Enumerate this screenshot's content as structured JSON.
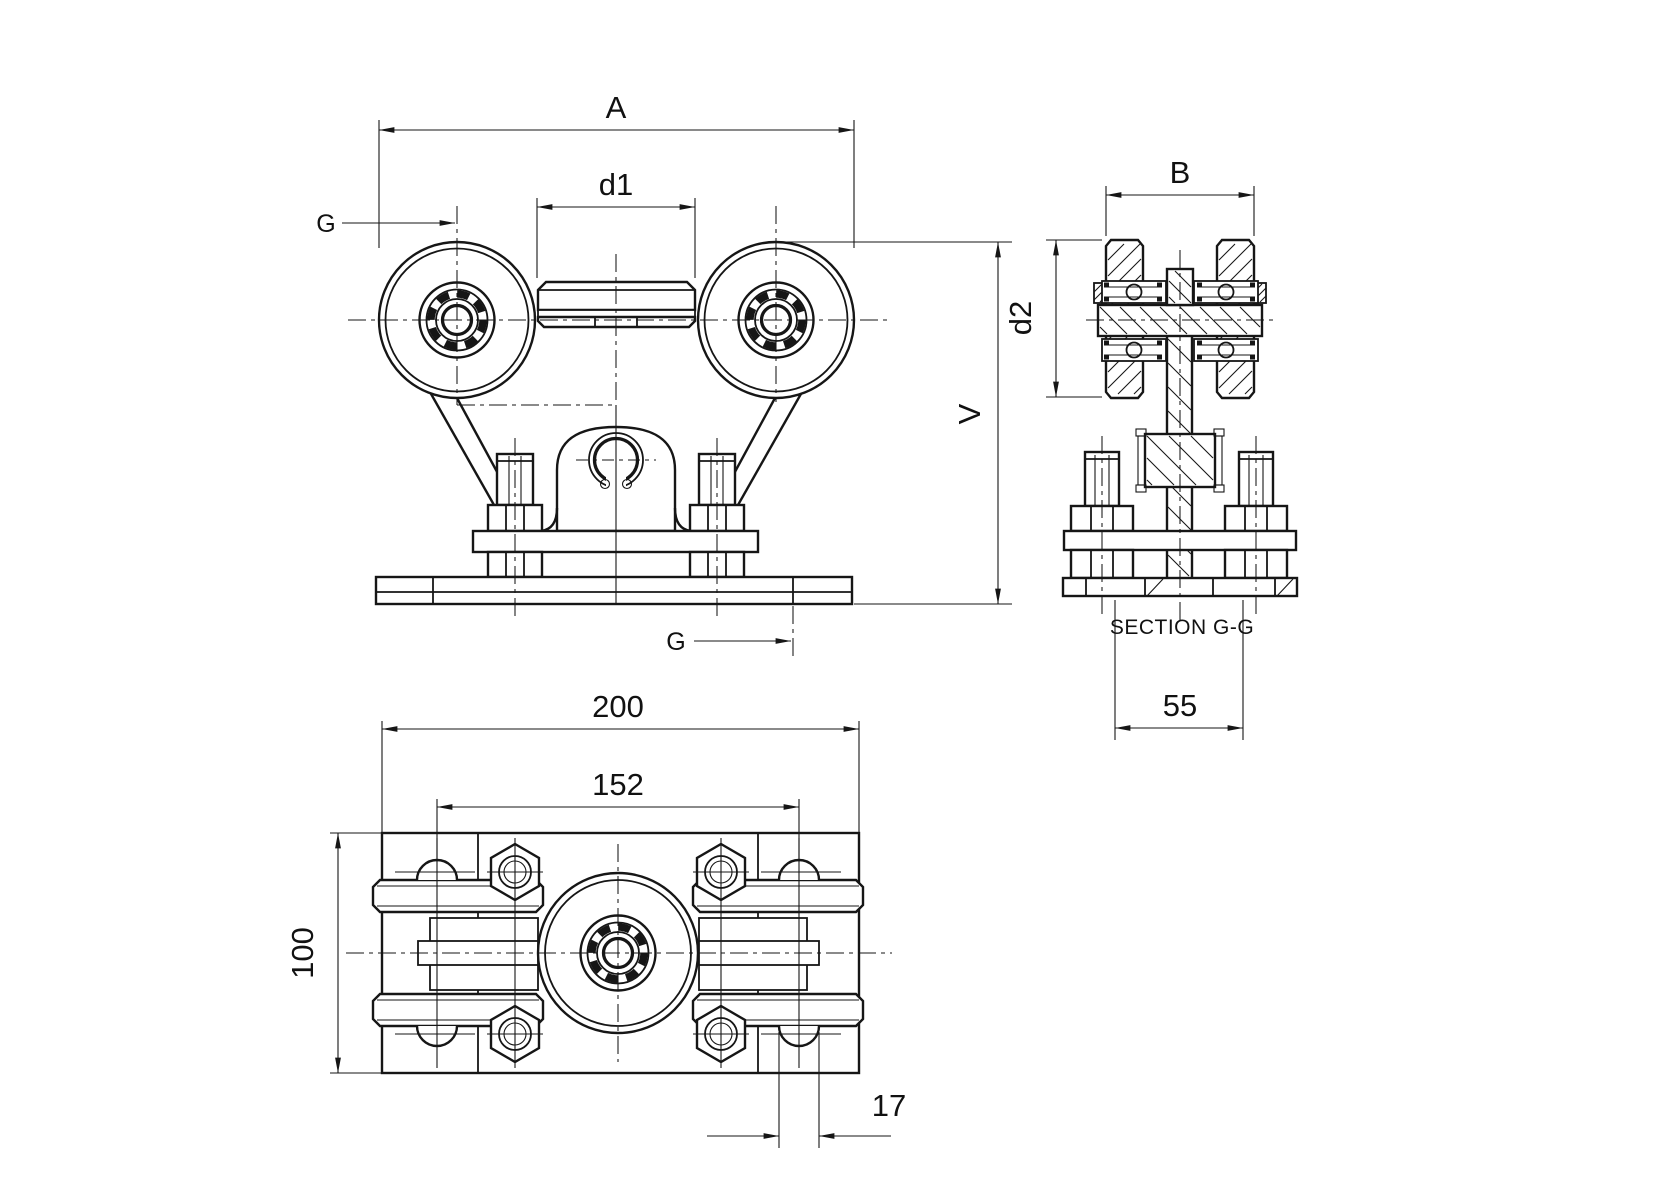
{
  "drawing_title": "Roller carriage technical drawing",
  "colors": {
    "line": "#161616",
    "background": "#ffffff"
  },
  "front": {
    "dim_a": "A",
    "dim_d1": "d1",
    "cut_top": "G",
    "cut_bottom": "G",
    "dim_v": "V"
  },
  "section": {
    "dim_b": "B",
    "dim_d2": "d2",
    "title": "SECTION G-G",
    "dim_55": "55"
  },
  "plan": {
    "dim_200": "200",
    "dim_152": "152",
    "dim_100": "100",
    "dim_17": "17"
  }
}
